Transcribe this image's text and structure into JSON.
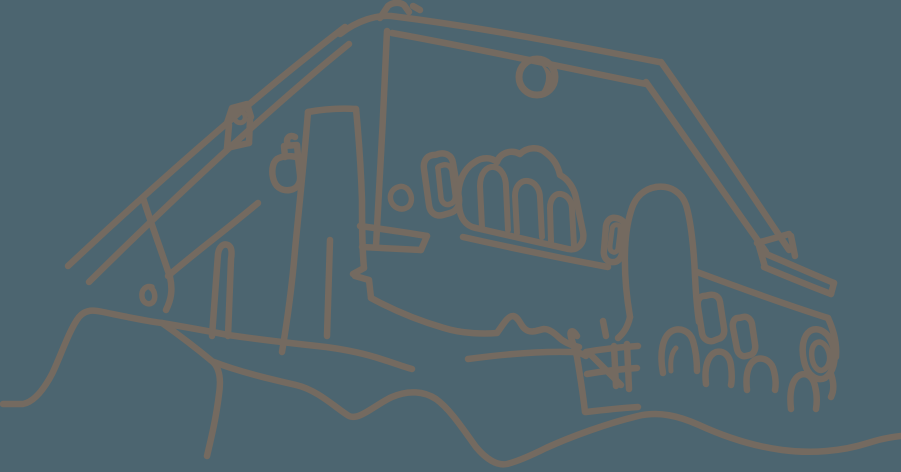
{
  "canvas": {
    "width": 901,
    "height": 472,
    "background_color": "#4C6570",
    "stroke_color": "#746A60",
    "stroke_width": 6.5
  },
  "drawing": {
    "description": "Hand-drawn single-color line sketch of a house with a large sweeping roof on a hilltop: apex finial, dormer chimney, large central chimney, hanging bell lamp, triple arched window, rectangular and round windows, right eave with gutter beam, fence, bushes, ring window and wavy foreground terrain.",
    "paths": [
      {
        "name": "ridge-outer",
        "d": "M340,34 C358,20 377,15 391,16 C480,27 572,45 659,62"
      },
      {
        "name": "ridge-inner",
        "d": "M392,33 C475,48 562,67 646,84"
      },
      {
        "name": "apex-finial",
        "d": "M380,18 L388,6 C393,2 400,2 404,5 L409,12"
      },
      {
        "name": "apex-tick",
        "d": "M413,6 L420,10"
      },
      {
        "name": "roof-left-outer",
        "d": "M345,27 C255,96 160,180 68,266"
      },
      {
        "name": "roof-left-inner",
        "d": "M349,44 C265,112 176,196 89,282"
      },
      {
        "name": "roof-left-eave",
        "d": "M258,203 C227,229 196,252 168,276"
      },
      {
        "name": "gable-wall-edge",
        "d": "M143,198 C152,226 162,253 170,277 C173,290 171,300 166,310"
      },
      {
        "name": "roof-right-outer",
        "d": "M661,62 C703,121 746,186 789,250"
      },
      {
        "name": "roof-right-inner",
        "d": "M646,82 C687,140 726,196 766,252"
      },
      {
        "name": "eave-box-a",
        "d": "M757,243 L789,234"
      },
      {
        "name": "eave-box-b",
        "d": "M791,236 L795,256"
      },
      {
        "name": "eave-box-c",
        "d": "M759,246 L765,267"
      },
      {
        "name": "gutter-top",
        "d": "M766,254 C790,264 812,274 834,283"
      },
      {
        "name": "gutter-bottom",
        "d": "M764,267 C788,277 810,286 831,294"
      },
      {
        "name": "gutter-end",
        "d": "M834,283 L831,294"
      },
      {
        "name": "right-wall-top",
        "d": "M697,272 C740,288 784,304 828,318"
      },
      {
        "name": "right-wall-edge",
        "d": "M828,318 C834,331 837,345 836,357"
      },
      {
        "name": "dormer-cap",
        "d": "M227,123 L232,108 L247,104 L251,117"
      },
      {
        "name": "dormer-ring",
        "d": "M238,111 C234,113 233,118 236,121 C239,124 244,123 245,119 C246,115 243,110 238,111",
        "w": 5
      },
      {
        "name": "dormer-body-left",
        "d": "M229,125 L227,148"
      },
      {
        "name": "dormer-body-right",
        "d": "M250,120 L249,143"
      },
      {
        "name": "dormer-base",
        "d": "M227,148 L249,143"
      },
      {
        "name": "bell-neck",
        "d": "M285,157 L284,146 L297,145 L298,156"
      },
      {
        "name": "bell-hook",
        "d": "M288,145 C285,138 290,134 295,137"
      },
      {
        "name": "bell-body",
        "d": "M277,159 C272,163 271,173 274,181 C277,189 284,191 290,190 C297,189 301,183 300,175 L298,158 C292,155 282,156 277,159"
      },
      {
        "name": "chimney-top",
        "d": "M308,112 C324,109 340,108 356,109"
      },
      {
        "name": "chimney-left",
        "d": "M308,112 C304,162 299,208 295,250 C292,287 287,322 282,352"
      },
      {
        "name": "chimney-inner",
        "d": "M330,240 C329,272 328,304 327,336"
      },
      {
        "name": "chimney-right",
        "d": "M356,109 C359,140 361,170 362,200 C362,224 362,248 364,268"
      },
      {
        "name": "chimney-step",
        "d": "M364,268 L353,274 M355,276 L369,280 L371,298"
      },
      {
        "name": "gable-edge-vertical",
        "d": "M387,31 C384,102 380,176 376,246"
      },
      {
        "name": "beam-top",
        "d": "M360,226 C382,229 404,232 427,236"
      },
      {
        "name": "beam-bottom",
        "d": "M362,247 C382,248 402,249 421,250"
      },
      {
        "name": "beam-end",
        "d": "M427,236 L421,250"
      },
      {
        "name": "lamp-knob",
        "d": "M398,187 C392,189 389,195 391,201 C393,207 400,211 406,208 C411,206 413,199 410,193 C408,188 403,185 398,187",
        "w": 5.5
      },
      {
        "name": "window-rect-outer",
        "d": "M433,155 C426,156 423,162 424,169 L429,205 C430,213 436,217 443,215 L450,213 C457,211 460,205 459,198 L453,163 C452,155 445,152 438,154 C436,155 434,155 433,155"
      },
      {
        "name": "window-rect-inner",
        "d": "M438,169 L441,198 C442,203 446,206 450,204 C454,203 456,199 455,194 L452,171 C451,166 447,164 443,165 C439,166 437,167 438,169",
        "w": 5.5
      },
      {
        "name": "triple-window-outline",
        "d": "M459,206 C456,186 462,170 475,162 C482,157 491,157 497,162 C500,153 511,149 520,154 C527,147 539,146 546,153 C553,158 558,166 560,175 C568,179 574,188 576,198 L583,232 C585,243 578,251 568,249 L476,228 C465,226 460,217 459,206"
      },
      {
        "name": "arched-window-1",
        "d": "M482,227 L480,186 C480,173 487,166 494,167 C501,168 506,176 506,187 L508,230",
        "w": 6
      },
      {
        "name": "arched-window-2",
        "d": "M517,233 L515,196 C515,186 521,180 528,181 C535,182 540,189 540,198 L542,237",
        "w": 6
      },
      {
        "name": "arched-window-3",
        "d": "M551,242 L550,208 C550,199 555,193 561,194 C567,195 572,201 572,209 L574,246",
        "w": 6
      },
      {
        "name": "window-sill",
        "d": "M463,237 C512,248 560,258 608,267"
      },
      {
        "name": "round-window-ring",
        "d": "M537,59 C527,59 519,67 519,77 C519,87 527,95 537,95 C547,95 555,87 555,77 C555,67 547,59 537,59",
        "w": 7
      },
      {
        "name": "round-window-crescent",
        "d": "M540,64 C548,67 552,72 552,78 C552,84 547,89 541,92 C545,86 546,81 546,77 C546,72 544,68 540,64 Z",
        "fill": true
      },
      {
        "name": "tower-left-edge",
        "d": "M630,317 C623,276 623,236 631,211 C635,197 644,189 656,187"
      },
      {
        "name": "tower-right-edge",
        "d": "M656,187 C671,185 682,193 686,205 C691,221 694,251 695,276 C696,296 697,309 699,322"
      },
      {
        "name": "tower-flare",
        "d": "M630,317 C628,326 624,333 618,338"
      },
      {
        "name": "tower-foot",
        "d": "M603,321 L606,336"
      },
      {
        "name": "small-window-outer",
        "d": "M604,250 L606,226 C607,220 611,217 616,218 C622,219 626,223 625,229 L622,253 C621,259 617,263 611,262 C606,261 603,256 604,250"
      },
      {
        "name": "small-window-inner",
        "d": "M610,246 L612,230 C612,226 615,224 618,225 C621,226 620,229 620,232 L618,248 C618,251 615,253 613,252 C610,251 610,249 610,246",
        "w": 5
      },
      {
        "name": "right-window-1",
        "d": "M703,296 C699,297 697,301 698,307 L702,333 C703,339 708,342 713,341 L718,339 C723,338 725,333 724,328 L720,302 C719,296 714,294 709,295 C706,296 704,296 703,296"
      },
      {
        "name": "right-window-2",
        "d": "M737,318 C734,319 732,323 733,328 L737,349 C738,354 742,357 746,356 L750,355 C754,354 756,349 755,344 L752,324 C751,319 747,316 743,317 C740,318 738,318 737,318"
      },
      {
        "name": "ring-window-outer",
        "d": "M810,331 C818,326 829,332 833,346 C837,360 833,373 825,378 C817,382 807,375 804,361 C801,348 803,336 810,331"
      },
      {
        "name": "ring-window-inner",
        "d": "M816,343 C821,340 827,345 829,353 C831,361 828,368 823,370 C818,372 813,366 812,358 C811,351 812,346 816,343",
        "w": 5.5
      },
      {
        "name": "ring-window-tail",
        "d": "M831,374 C834,383 834,391 831,397"
      },
      {
        "name": "terrain-left-hill",
        "d": "M3,404 L23,404 C33,402 43,391 52,374 C60,358 69,330 79,317 C86,309 94,310 103,312 C118,315 140,320 162,323 C185,327 208,331 228,335"
      },
      {
        "name": "terrain-base",
        "d": "M228,335 C262,340 298,344 326,347 C348,350 366,354 381,359 C394,363 404,367 412,369"
      },
      {
        "name": "hill-edge",
        "d": "M162,323 C182,337 201,352 213,362 C220,369 221,381 219,394 C216,419 211,439 207,456"
      },
      {
        "name": "ledge-line",
        "d": "M371,298 C395,311 420,321 444,328 C463,334 485,334 497,333 C504,323 508,316 513,316 C519,317 520,325 525,329 C531,334 538,330 544,329 C551,329 557,336 562,340 C568,344 574,346 579,347"
      },
      {
        "name": "terrace-line",
        "d": "M468,359 C505,354 540,351 572,352 C578,352 583,354 586,356"
      },
      {
        "name": "curl-window",
        "d": "M152,287 C146,285 141,290 142,297 C143,303 149,306 153,302 C156,298 155,291 151,288",
        "w": 5.5
      },
      {
        "name": "left-chimney",
        "d": "M212,336 L218,254 C219,247 223,243 228,245 C232,247 232,253 231,259 L228,336"
      },
      {
        "name": "fence-post",
        "d": "M577,336 C573,329 569,330 571,337 C573,344 576,352 577,357 C580,375 583,394 585,412"
      },
      {
        "name": "fence-rail-top",
        "d": "M586,352 C603,349 621,347 638,346"
      },
      {
        "name": "fence-rail-bottom",
        "d": "M587,374 C604,371 621,369 637,368"
      },
      {
        "name": "fence-picket-1",
        "d": "M614,346 L616,386"
      },
      {
        "name": "fence-picket-2",
        "d": "M627,344 L629,389"
      },
      {
        "name": "fence-brace",
        "d": "M589,353 L621,385"
      },
      {
        "name": "fence-base",
        "d": "M586,412 C603,410 621,408 638,407"
      },
      {
        "name": "bush-1",
        "d": "M663,373 C659,352 663,336 672,331 C680,327 690,331 693,341 C696,351 697,362 697,371"
      },
      {
        "name": "bush-1-inner",
        "d": "M671,371 C670,360 672,352 676,348",
        "w": 5
      },
      {
        "name": "bush-2",
        "d": "M706,384 C704,367 708,355 716,352 C724,350 730,356 731,366 C732,374 732,380 731,385"
      },
      {
        "name": "bush-3",
        "d": "M747,390 C745,373 749,362 757,359 C765,357 772,362 774,371 C776,379 776,385 775,390"
      },
      {
        "name": "bush-4",
        "d": "M791,409 C789,392 792,379 800,375 C807,372 813,377 815,386 C817,394 817,403 816,409"
      },
      {
        "name": "foreground-wave",
        "d": "M214,362 C240,372 270,379 296,385 C318,390 337,409 349,416 C359,421 376,404 392,397 C408,390 424,391 436,399 C450,409 463,429 476,447 C486,459 497,466 507,464 C519,461 532,455 546,448 C570,437 608,423 638,416 C659,411 679,416 699,425 C723,436 752,446 782,450 C812,454 843,451 868,443 C880,439 891,437 901,436"
      }
    ]
  }
}
